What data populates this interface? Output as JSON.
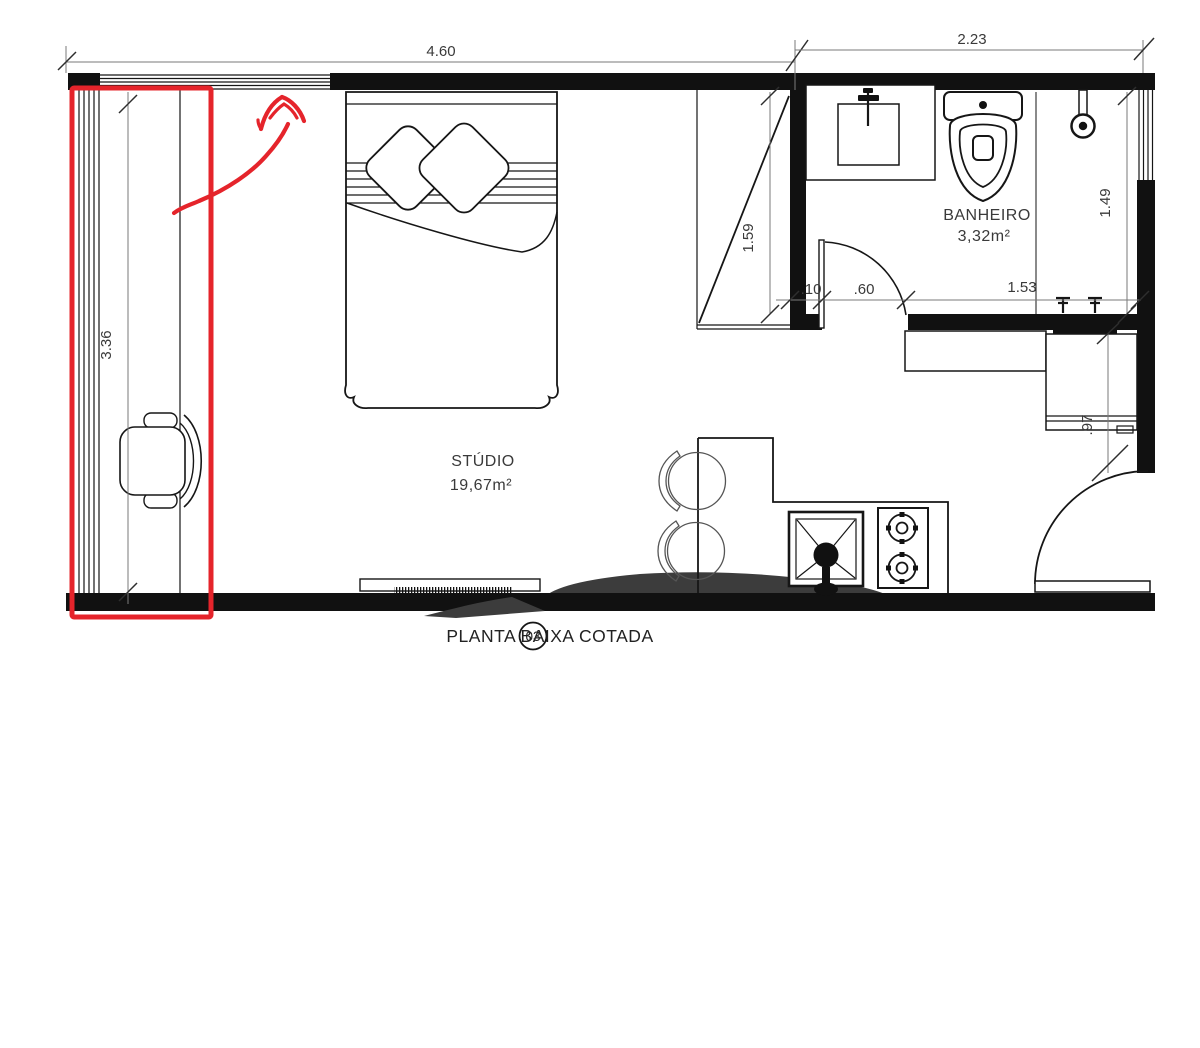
{
  "title": {
    "number": "03",
    "label": "PLANTA BAIXA COTADA"
  },
  "rooms": {
    "studio": {
      "name": "STÚDIO",
      "area": "19,67m²"
    },
    "bathroom": {
      "name": "BANHEIRO",
      "area": "3,32m²"
    }
  },
  "dimensions": {
    "width_main": "4.60",
    "width_bathroom": "2.23",
    "height_left": "3.36",
    "closet_height": "1.59",
    "bathroom_height_right": "1.49",
    "door_jamb": ".10",
    "door_width": ".60",
    "bathroom_bottom": "1.53",
    "cabinet_depth": ".97"
  },
  "colors": {
    "drawing_line": "#161616",
    "annotation_red": "#e5242b",
    "dimension_text": "#3a3a3a",
    "watermark_gray": "#3c3c3c"
  }
}
